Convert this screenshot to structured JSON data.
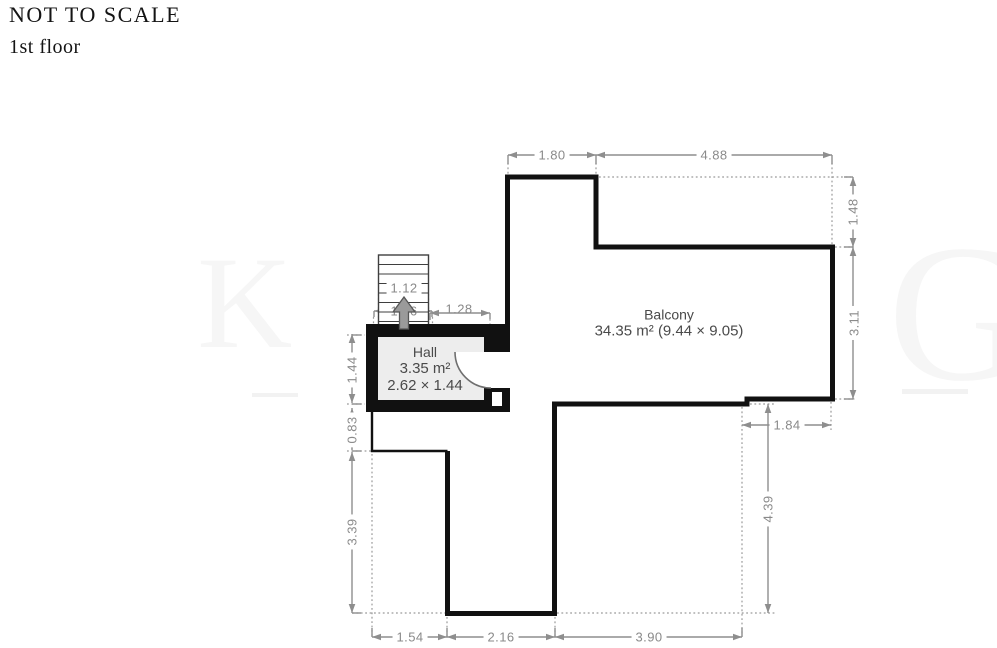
{
  "page": {
    "title": "NOT TO SCALE",
    "subtitle": "1st floor"
  },
  "watermark": {
    "left": "K",
    "right": "G"
  },
  "rooms": {
    "hall": {
      "name": "Hall",
      "area": "3.35 m²",
      "size": "2.62 × 1.44"
    },
    "balcony": {
      "name": "Balcony",
      "details": "34.35 m² (9.44 × 9.05)"
    }
  },
  "dimensions": {
    "top_left_width": "1.80",
    "top_right_width": "4.88",
    "right_step_height": "1.48",
    "right_balcony_height": "3.11",
    "right_notch_width": "1.84",
    "right_lower_height": "4.39",
    "bottom_left_width": "1.54",
    "bottom_middle_width": "2.16",
    "bottom_right_width": "3.90",
    "left_hall_height": "1.44",
    "left_step_height": "0.83",
    "left_lower_height": "3.39",
    "stair_inner_width": "1.12",
    "stair_outer_width": "1.26",
    "hall_top_width": "1.28"
  },
  "colors": {
    "wall": "#111111",
    "dimension_line": "#8e8e8e",
    "hall_fill": "#ededed",
    "room_label": "#4a4a4a",
    "watermark": "#f6f6f6"
  }
}
